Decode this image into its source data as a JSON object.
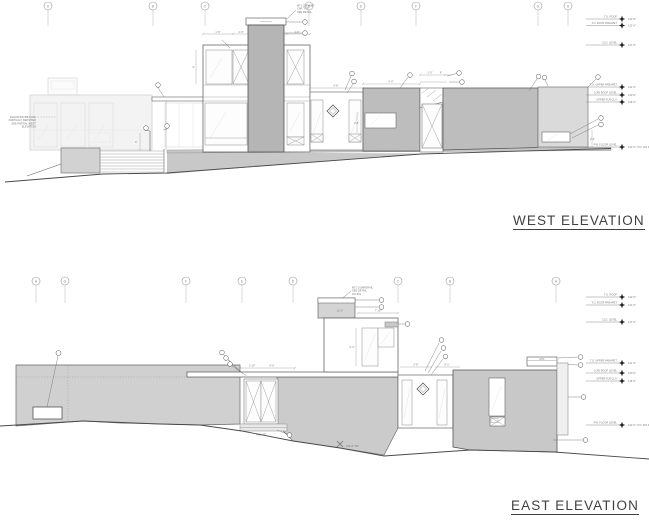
{
  "sheet": {
    "background": "#ffffff"
  },
  "west": {
    "title": "WEST ELEVATION",
    "grids": [
      "A",
      "B",
      "C",
      "D",
      "E",
      "F",
      "G",
      "H"
    ],
    "levels": [
      {
        "label": "T.O. ROOF",
        "elev": "132'-6\""
      },
      {
        "label": "T.O. ROOF PARAPET",
        "elev": "131'-0\""
      },
      {
        "label": "CLG. LEVEL",
        "elev": "127'-6\""
      },
      {
        "label": "T.O. UPPER PARAPET",
        "elev": "121'-6\""
      },
      {
        "label": "LOW ROOF LEVEL",
        "elev": "120'-0\""
      },
      {
        "label": "UPPER FLR CLG",
        "elev": "118'-6\""
      },
      {
        "label": "FIN. FLOOR LEVEL",
        "elev": "110'-0\" (T.O. FIN FLR)"
      }
    ],
    "note_lines": [
      "ELEVATION BEYOND",
      "PARTIALLY DEPICTED",
      "SEE PARTIAL WEST",
      "ELEVATION"
    ],
    "chimney_note_lines": [
      "MTL CHIMNEY",
      "CAP, TYP.",
      "SEE DETAIL"
    ],
    "dims": {
      "d1": "1'-6\"",
      "d2": "4'-0\"",
      "d3": "1'-6\"",
      "d4": "9'",
      "d5": "5'-8\"",
      "d6": "2'-6\"",
      "d7": "1'-0\"",
      "d8": "6\"",
      "d9": "4'-0\"",
      "d10": "2'-0\"",
      "d11": "3'"
    }
  },
  "east": {
    "title": "EAST ELEVATION",
    "grids": [
      "H",
      "G",
      "F",
      "E",
      "D",
      "C",
      "B",
      "A"
    ],
    "levels": [
      {
        "label": "T.O. ROOF",
        "elev": "132'-6\""
      },
      {
        "label": "T.O. ROOF PARAPET",
        "elev": "131'-0\""
      },
      {
        "label": "CLG. LEVEL",
        "elev": "127'-6\""
      },
      {
        "label": "T.O. UPPER PARAPET",
        "elev": "121'-6\""
      },
      {
        "label": "LOW ROOF LEVEL",
        "elev": "120'-0\""
      },
      {
        "label": "UPPER FLR CLG",
        "elev": "118'-6\""
      },
      {
        "label": "FIN. FLOOR LEVEL",
        "elev": "110'-0\" (T.O. FIN FLR)"
      }
    ],
    "roof_note_lines": [
      "MTL GUARDRAIL",
      "SEE DETAIL",
      "3/A-501"
    ],
    "high_pt_label": "HIGH PT",
    "tw_label": "110'-2\" TW",
    "box_label": "MTL",
    "dims": {
      "d1": "7'-10\"",
      "d2": "11'-0\"",
      "d3": "1'-10\"",
      "d4": "6'-0\"",
      "d5": "2'-8\"",
      "d6": "8'-1\"",
      "d7": "3'-4\""
    }
  }
}
